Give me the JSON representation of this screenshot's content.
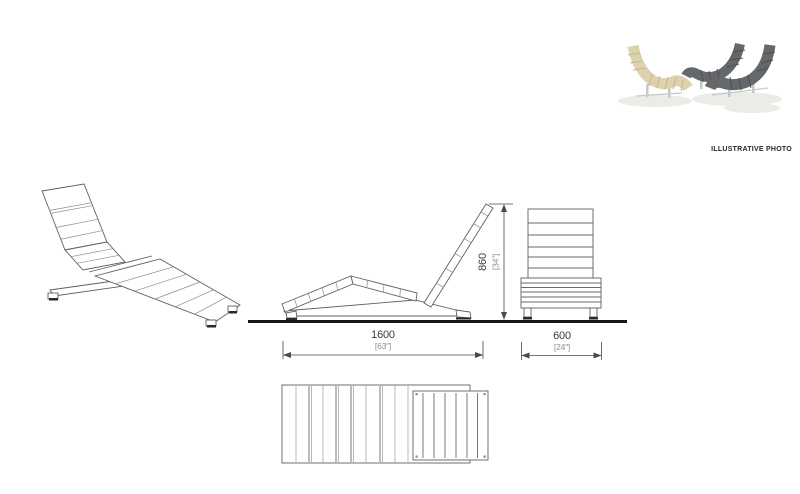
{
  "page": {
    "width": 800,
    "height": 494,
    "background": "#ffffff"
  },
  "drawing": {
    "line_color": "#606060",
    "ground_color": "#161616",
    "dim_color": "#3c3c3c",
    "dim_secondary_color": "#8e8e8e"
  },
  "photo": {
    "label": "ILLUSTRATIVE PHOTO",
    "beige_color": "#dcd2ae",
    "beige_gap_color": "#c3b68d",
    "gray_color": "#64686b",
    "gray_gap_color": "#4b4f52",
    "leg_color": "#c6c8c9",
    "shadow_color": "#ebebe8"
  },
  "dimensions": {
    "length_mm": "1600",
    "length_in": "[63″]",
    "width_mm": "600",
    "width_in": "[24″]",
    "height_mm": "860",
    "height_in": "[34″]"
  }
}
